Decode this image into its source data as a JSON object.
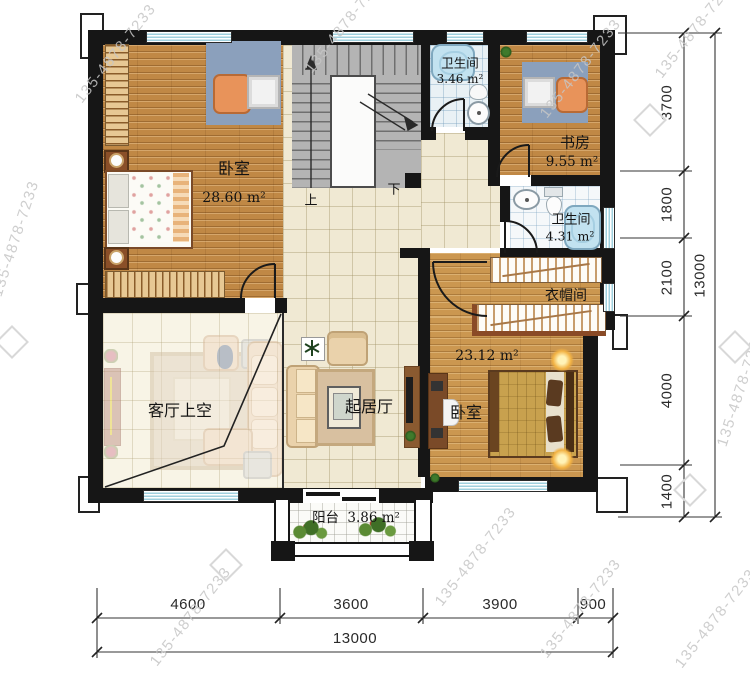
{
  "watermark": {
    "text": "135-4878-7233"
  },
  "stair": {
    "up": "上",
    "down": "下"
  },
  "rooms": {
    "bedroom_top": {
      "name": "卧室",
      "area": "28.60 m²"
    },
    "bath_top": {
      "name": "卫生间",
      "area": "3.46 m²"
    },
    "study": {
      "name": "书房",
      "area": "9.55 m²"
    },
    "bath_mid": {
      "name": "卫生间",
      "area": "4.31 m²"
    },
    "cloakroom": {
      "name": "衣帽间"
    },
    "bedroom_bottom": {
      "name": "卧室",
      "area": "23.12 m²"
    },
    "living_void": {
      "name": "客厅上空"
    },
    "sitting": {
      "name": "起居厅"
    },
    "balcony": {
      "name": "阳台",
      "area": "3.86 m²"
    }
  },
  "dimensions": {
    "right": [
      "3700",
      "1800",
      "2100",
      "4000",
      "1400"
    ],
    "right_total": "13000",
    "bottom": [
      "4600",
      "3600",
      "3900",
      "900"
    ],
    "bottom_total": "13000"
  },
  "colors": {
    "wall": "#161616",
    "wood_floor": "#c08845",
    "wood_floor_light": "#cb9750",
    "tile_cream": "#f0e9d3",
    "tile_pale": "#f8f4e6",
    "bath_blue": "#c2e2f0",
    "window_blue": "#9fd0de",
    "stair_gray": "#b4b4b4",
    "desk_nook_blue": "#8ba0bc",
    "accent_chair_orange": "#e8935a"
  }
}
